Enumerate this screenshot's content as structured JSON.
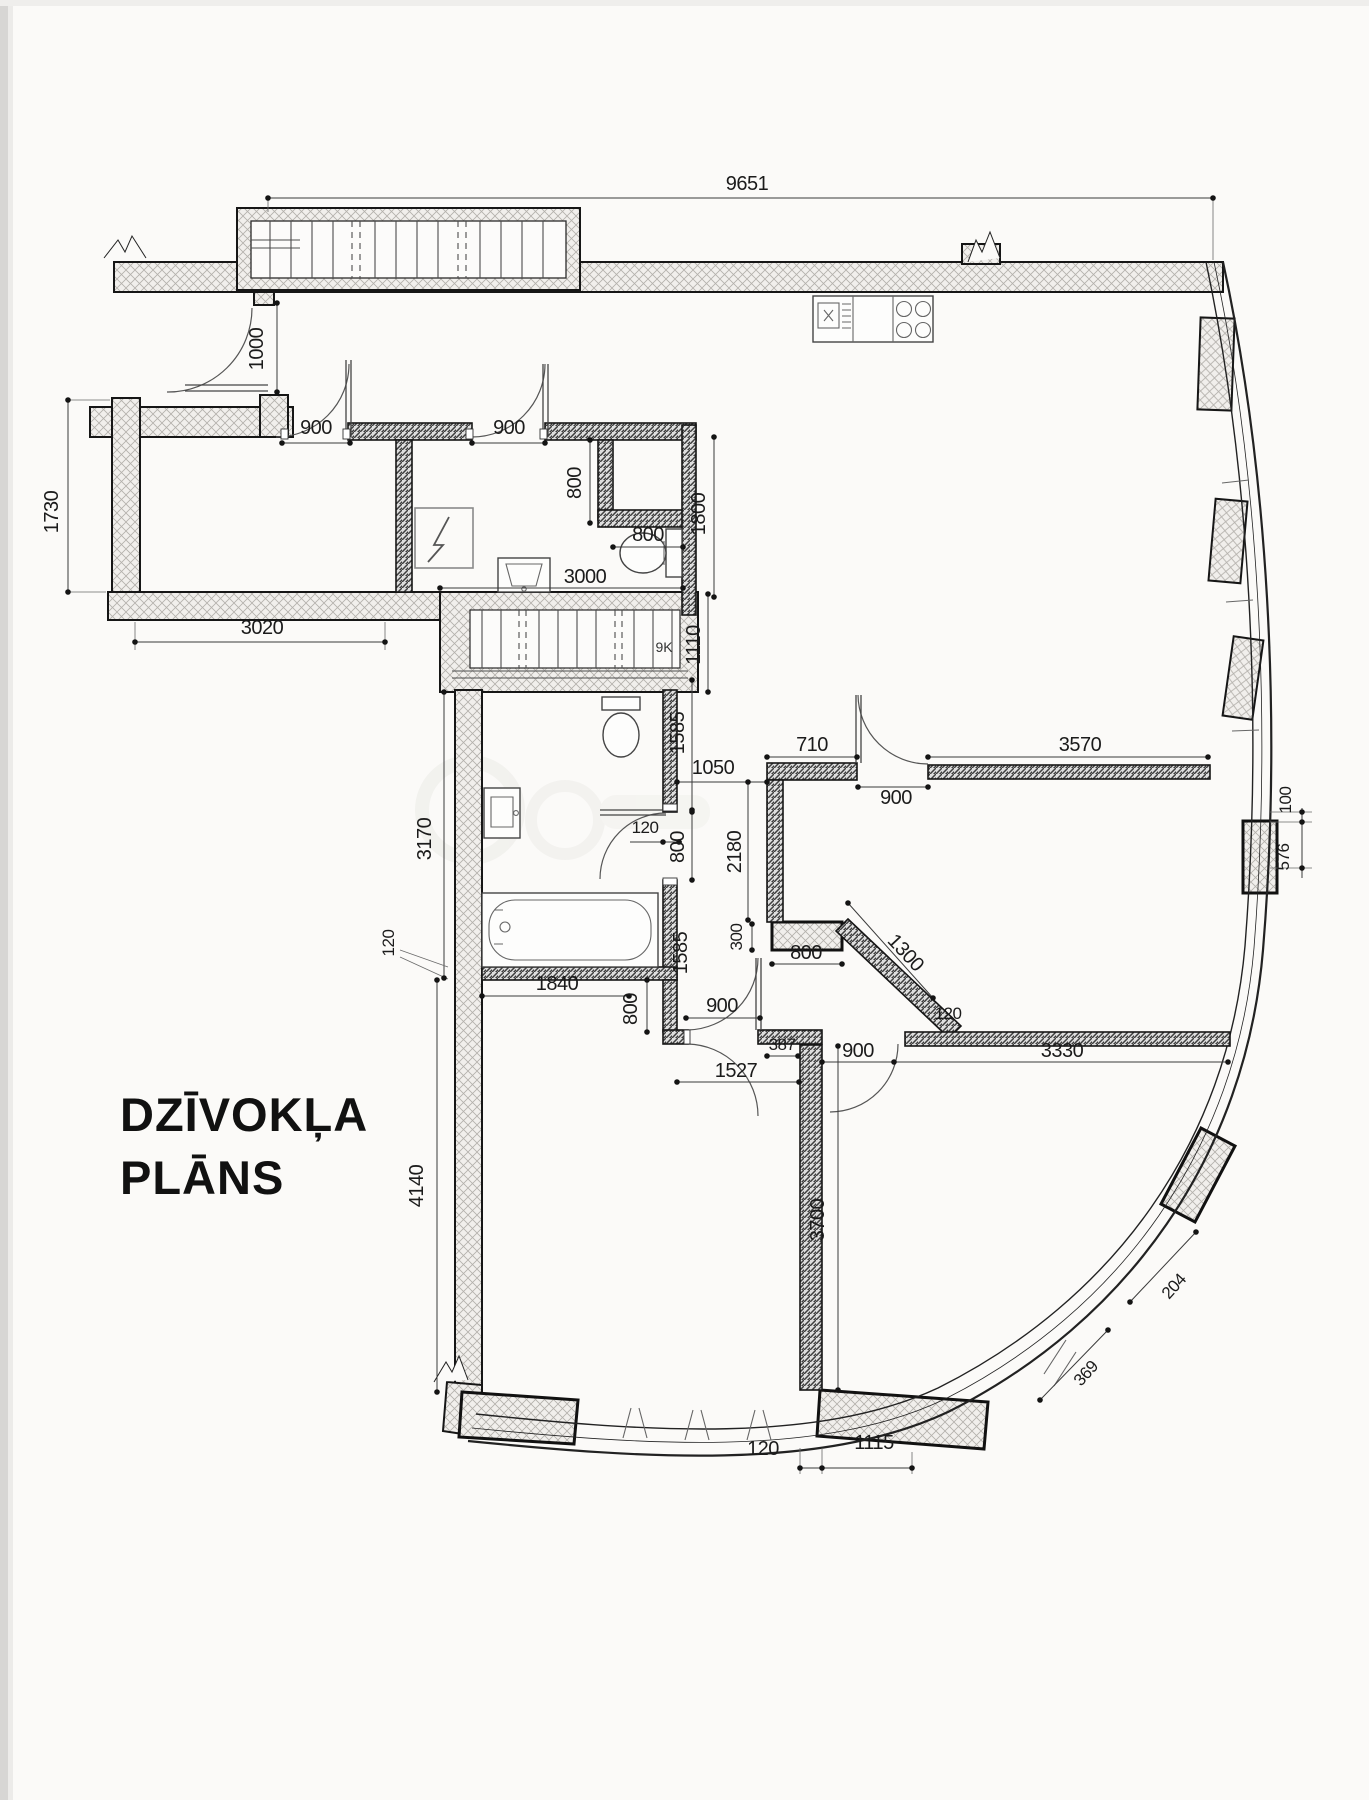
{
  "title": {
    "line1": "DZĪVOKĻA",
    "line2": "PLĀNS"
  },
  "stairs": {
    "label": "9K"
  },
  "colors": {
    "paper": "#fbfaf8",
    "ink": "#1b1b1b"
  },
  "dims": {
    "top_width": "9651",
    "entry_door": "1000",
    "hall_door_left": "900",
    "hall_door_right": "900",
    "niche_depth": "800",
    "niche_width": "800",
    "kitchen_wall": "1800",
    "wc_width": "3000",
    "room1_width": "3020",
    "room1_height": "1730",
    "stair_depth": "1110",
    "bath_wall_upper": "1585",
    "hall_gap": "1050",
    "bath_wall_thick": "120",
    "bath_door": "800",
    "wall_2180": "2180",
    "wall_710": "710",
    "room2_door": "900",
    "wall_3570": "3570",
    "pier_gap": "100",
    "pier_width": "576",
    "bath_height": "3170",
    "bath_bottom_thick": "120",
    "block_300": "300",
    "block_800": "800",
    "diag_wall": "1300",
    "tub_length": "1840",
    "door6_wall": "800",
    "door6_width": "900",
    "bath_wall_lower": "1585",
    "step_120": "120",
    "wall_3330": "3330",
    "door8_width": "900",
    "wall_387": "387",
    "corridor_1527": "1527",
    "room3_height": "4140",
    "wall_3700": "3700",
    "bottom_120": "120",
    "bottom_1115": "1115",
    "win_369": "369",
    "win_204": "204"
  }
}
